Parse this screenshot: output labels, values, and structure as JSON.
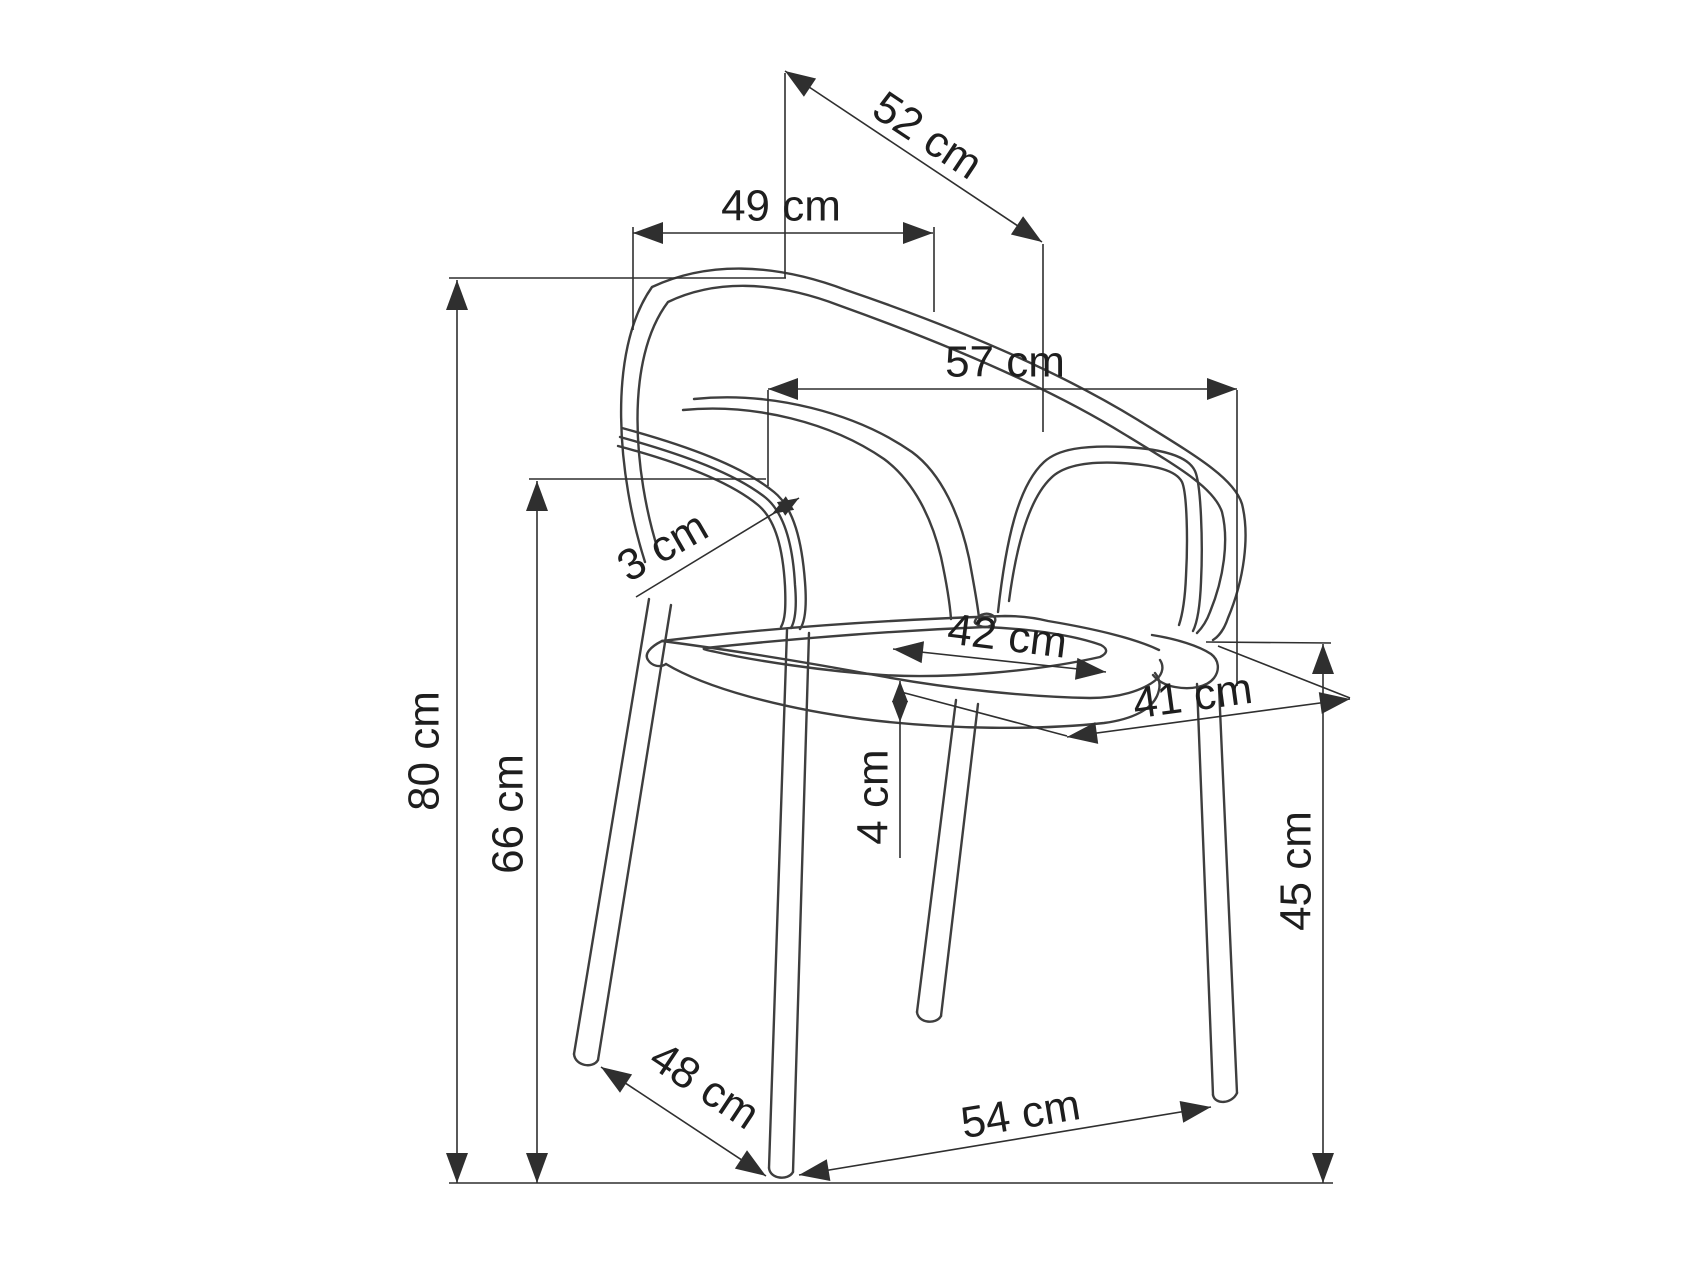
{
  "page": {
    "background": "#ffffff",
    "description": "technical-dimension-line-drawing-of-stackable-armchair"
  },
  "diagram": {
    "unit": "cm",
    "canvas": {
      "width": 1702,
      "height": 1276
    },
    "style": {
      "line_color": "#3e3e3e",
      "dim_color": "#2f2f2f",
      "text_color": "#1e1e1e",
      "font_size": 44,
      "arrow_normal": {
        "length": 30,
        "half_width": 11
      },
      "arrow_small": {
        "length": 21,
        "half_width": 8
      }
    },
    "ground_line": [
      449,
      1183,
      1333,
      1183
    ],
    "measurements": [
      {
        "id": "back-top-diagonal",
        "label": "52 cm",
        "value": 52,
        "line": [
          785,
          71,
          1042,
          242
        ],
        "size": "normal",
        "arrows": [
          {
            "tip": [
              785,
              71
            ],
            "angle": -146.4
          },
          {
            "tip": [
              1042,
              242
            ],
            "angle": 33.6
          }
        ],
        "label_pos": [
          926,
          138
        ],
        "label_rot": 33.6,
        "ext": [
          [
            785,
            73,
            785,
            278
          ],
          [
            1043,
            244,
            1043,
            432
          ]
        ]
      },
      {
        "id": "backrest-width",
        "label": "49 cm",
        "value": 49,
        "line": [
          633,
          233,
          933,
          233
        ],
        "size": "normal",
        "arrows": [
          {
            "tip": [
              633,
              233
            ],
            "angle": 180
          },
          {
            "tip": [
              933,
              233
            ],
            "angle": 0
          }
        ],
        "label_pos": [
          781,
          209
        ],
        "label_rot": 0,
        "ext": [
          [
            633,
            227,
            633,
            330
          ],
          [
            934,
            227,
            934,
            312
          ]
        ]
      },
      {
        "id": "overall-width",
        "label": "57 cm",
        "value": 57,
        "line": [
          768,
          389,
          1237,
          389
        ],
        "size": "normal",
        "arrows": [
          {
            "tip": [
              768,
              389
            ],
            "angle": 180
          },
          {
            "tip": [
              1237,
              389
            ],
            "angle": 0
          }
        ],
        "label_pos": [
          1005,
          365
        ],
        "label_rot": 0,
        "ext": [
          [
            768,
            390,
            768,
            486
          ],
          [
            1237,
            390,
            1237,
            686
          ]
        ]
      },
      {
        "id": "armrest-thickness",
        "label": "3 cm",
        "value": 3,
        "line": [
          636,
          597,
          799,
          498
        ],
        "size": "small",
        "arrows": [
          {
            "tip": [
              799,
              498
            ],
            "angle": -31.3
          },
          {
            "tip": [
              772,
              514
            ],
            "angle": 148.7
          }
        ],
        "label_pos": [
          664,
          549
        ],
        "label_rot": -30,
        "ext": []
      },
      {
        "id": "seat-width",
        "label": "42 cm",
        "value": 42,
        "line": [
          893,
          649,
          1106,
          672
        ],
        "size": "normal",
        "arrows": [
          {
            "tip": [
              893,
              649
            ],
            "angle": -173.8
          },
          {
            "tip": [
              1106,
              672
            ],
            "angle": 6.2
          }
        ],
        "label_pos": [
          1007,
          639
        ],
        "label_rot": 7,
        "ext": []
      },
      {
        "id": "seat-depth",
        "label": "41 cm",
        "value": 41,
        "line": [
          1067,
          737,
          1350,
          699
        ],
        "size": "normal",
        "arrows": [
          {
            "tip": [
              1067,
              737
            ],
            "angle": 172.3
          },
          {
            "tip": [
              1350,
              699
            ],
            "angle": -7.7
          }
        ],
        "label_pos": [
          1193,
          699
        ],
        "label_rot": -7.7,
        "ext": [
          [
            901,
            692,
            1067,
            736
          ],
          [
            1218,
            646,
            1350,
            698
          ]
        ]
      },
      {
        "id": "seat-rim-thickness",
        "label": "4 cm",
        "value": 4,
        "line": [
          900,
          681,
          900,
          858
        ],
        "size": "small",
        "arrows": [
          {
            "tip": [
              900,
              681
            ],
            "angle": -90
          },
          {
            "tip": [
              900,
              722
            ],
            "angle": 90
          }
        ],
        "label_pos": [
          876,
          797
        ],
        "label_rot": -90,
        "ext": []
      },
      {
        "id": "overall-height",
        "label": "80 cm",
        "value": 80,
        "line": [
          457,
          280,
          457,
          1183
        ],
        "size": "normal",
        "arrows": [
          {
            "tip": [
              457,
              280
            ],
            "angle": -90
          },
          {
            "tip": [
              457,
              1183
            ],
            "angle": 90
          }
        ],
        "label_pos": [
          427,
          751
        ],
        "label_rot": -90,
        "ext": [
          [
            449,
            278,
            786,
            278
          ]
        ]
      },
      {
        "id": "armrest-height",
        "label": "66 cm",
        "value": 66,
        "line": [
          537,
          481,
          537,
          1183
        ],
        "size": "normal",
        "arrows": [
          {
            "tip": [
              537,
              481
            ],
            "angle": -90
          },
          {
            "tip": [
              537,
              1183
            ],
            "angle": 90
          }
        ],
        "label_pos": [
          511,
          814
        ],
        "label_rot": -90,
        "ext": [
          [
            529,
            479,
            766,
            479
          ]
        ]
      },
      {
        "id": "seat-height",
        "label": "45 cm",
        "value": 45,
        "line": [
          1323,
          644,
          1323,
          1183
        ],
        "size": "normal",
        "arrows": [
          {
            "tip": [
              1323,
              644
            ],
            "angle": -90
          },
          {
            "tip": [
              1323,
              1183
            ],
            "angle": 90
          }
        ],
        "label_pos": [
          1299,
          871
        ],
        "label_rot": -90,
        "ext": [
          [
            1206,
            642,
            1331,
            643
          ]
        ]
      },
      {
        "id": "base-depth",
        "label": "48 cm",
        "value": 48,
        "line": [
          601,
          1067,
          766,
          1176
        ],
        "size": "normal",
        "arrows": [
          {
            "tip": [
              601,
              1067
            ],
            "angle": -146.6
          },
          {
            "tip": [
              766,
              1176
            ],
            "angle": 33.4
          }
        ],
        "label_pos": [
          703,
          1088
        ],
        "label_rot": 33.5,
        "ext": []
      },
      {
        "id": "base-width",
        "label": "54 cm",
        "value": 54,
        "line": [
          799,
          1175,
          1211,
          1107
        ],
        "size": "normal",
        "arrows": [
          {
            "tip": [
              799,
              1175
            ],
            "angle": 170.6
          },
          {
            "tip": [
              1211,
              1107
            ],
            "angle": -9.4
          }
        ],
        "label_pos": [
          1021,
          1117
        ],
        "label_rot": -9.4,
        "ext": []
      }
    ],
    "chair": {
      "paths": [
        {
          "name": "backrest-outer",
          "d": "M 645,562 C 618,478 606,352 652,287 C 706,262 772,262 846,290 C 940,322 1050,366 1138,420 C 1196,456 1234,478 1242,504 C 1250,536 1244,580 1228,618 C 1224,630 1218,637 1213,640"
        },
        {
          "name": "backrest-inner",
          "d": "M 658,550 C 634,474 624,360 668,302 C 714,280 772,280 838,305 C 930,338 1040,382 1124,434 C 1180,468 1214,488 1222,512 C 1229,540 1224,578 1210,612 C 1206,623 1201,629 1197,633"
        },
        {
          "name": "back-panel-left",
          "d": "M 694,399 C 772,391 856,413 912,452 C 942,474 960,516 969,558 C 975,590 978,608 979,618"
        },
        {
          "name": "back-panel-left-inner",
          "d": "M 683,410 C 755,403 832,423 884,459 C 914,481 932,519 941,557 C 947,585 950,605 951,619"
        },
        {
          "name": "armrest-left-outer",
          "d": "M 622,428 C 688,446 742,466 774,492 C 794,508 802,542 805,582 C 807,608 805,622 800,629"
        },
        {
          "name": "armrest-left-mid",
          "d": "M 620,437 C 685,455 736,474 766,498 C 785,514 793,547 795,585 C 797,608 795,621 791,628"
        },
        {
          "name": "armrest-left-inner",
          "d": "M 618,446 C 682,463 730,482 758,505 C 776,520 783,550 785,586 C 786,609 785,620 781,627"
        },
        {
          "name": "armrest-right-opening",
          "d": "M 998,612 C 1006,540 1018,486 1044,462 C 1058,449 1084,445 1124,447 C 1163,449 1188,456 1195,471 C 1201,484 1203,542 1201,582 C 1200,607 1197,623 1193,631"
        },
        {
          "name": "armrest-right-opening-inner",
          "d": "M 1009,601 C 1016,548 1028,500 1051,478 C 1063,466 1086,461 1121,463 C 1154,465 1176,470 1182,482 C 1187,493 1188,540 1186,576 C 1185,600 1182,616 1179,625"
        },
        {
          "name": "seat-far-edge",
          "d": "M 662,641 C 760,629 880,620 1005,616 C 1022,616 1036,618 1048,621 C 1096,629 1136,639 1159,650"
        },
        {
          "name": "seat-near-edge",
          "d": "M 662,641 C 730,650 800,661 880,676 C 950,689 1030,697 1090,698 C 1118,698 1143,691 1157,679 C 1163,673 1164,666 1160,660"
        },
        {
          "name": "seat-band-bottom",
          "d": "M 666,664 C 706,688 780,708 862,719 C 950,730 1040,730 1104,723 C 1134,719 1151,709 1157,696 C 1161,687 1160,679 1155,673"
        },
        {
          "name": "seat-cushion-inner",
          "d": "M 706,648 C 790,639 890,631 985,627 C 1035,629 1076,636 1101,645 C 1108,649 1108,653 1100,657 C 1038,671 950,679 882,675 C 824,671 756,661 716,652 C 707,650 700,649 706,648"
        },
        {
          "name": "seat-left-corner",
          "d": "M 662,641 C 650,647 644,654 648,660 C 652,666 660,668 666,664"
        },
        {
          "name": "frame-corner",
          "d": "M 1152,635 C 1177,639 1199,646 1211,654 C 1219,660 1220,670 1214,678 C 1207,687 1191,690 1175,687 C 1164,685 1157,680 1153,675"
        },
        {
          "name": "panel-foot-detail",
          "d": "M 975,621 C 978,613 991,611 995,618 C 997,624 988,629 980,626 C 976,624 974,623 975,621"
        },
        {
          "name": "leg-back-left-a",
          "d": "M 649,599 L 574,1054"
        },
        {
          "name": "leg-back-left-b",
          "d": "M 671,605 L 598,1060"
        },
        {
          "name": "leg-back-left-foot",
          "d": "M 574,1054 C 575,1066 593,1069 598,1060"
        },
        {
          "name": "leg-front-left-a",
          "d": "M 787,630 L 769,1168"
        },
        {
          "name": "leg-front-left-b",
          "d": "M 809,633 L 793,1172"
        },
        {
          "name": "leg-front-left-foot",
          "d": "M 769,1168 C 770,1179 788,1181 793,1172"
        },
        {
          "name": "leg-back-right-a",
          "d": "M 956,700 L 917,1012"
        },
        {
          "name": "leg-back-right-b",
          "d": "M 978,704 L 941,1016"
        },
        {
          "name": "leg-back-right-foot",
          "d": "M 917,1012 C 918,1023 936,1025 941,1016"
        },
        {
          "name": "leg-front-right-a",
          "d": "M 1197,684 L 1213,1095"
        },
        {
          "name": "leg-front-right-b",
          "d": "M 1219,687 L 1237,1093"
        },
        {
          "name": "leg-front-right-foot",
          "d": "M 1213,1095 C 1215,1105 1232,1104 1237,1093"
        }
      ]
    }
  }
}
